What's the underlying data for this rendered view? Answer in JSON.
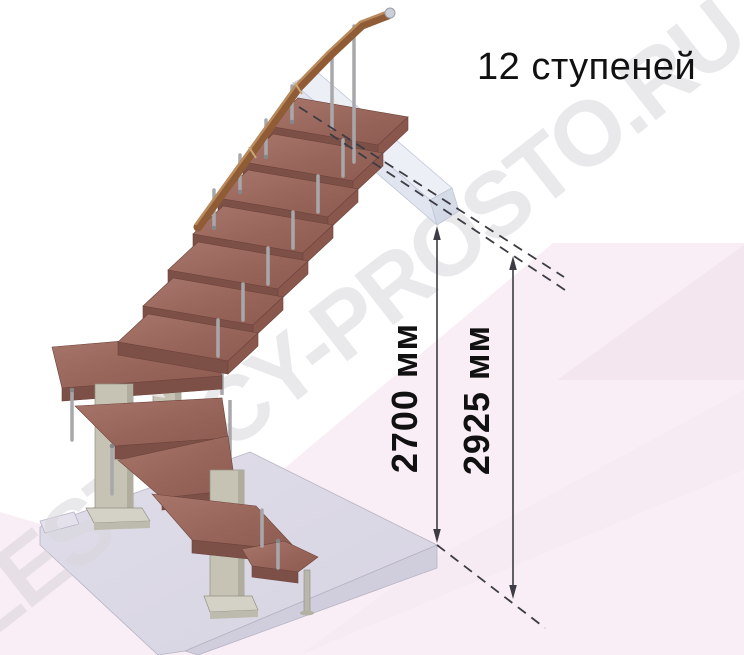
{
  "annotation": {
    "steps_label": "12 ступеней"
  },
  "dimensions": {
    "clear_height": "2700 мм",
    "total_height": "2925 мм"
  },
  "watermark": {
    "text": "LESTNICY-PROSTO.RU"
  },
  "figure": {
    "steps_count": "12"
  },
  "palette": {
    "tread_wood_top": "#9c685e",
    "tread_wood_front": "#7d5047",
    "handrail_wood": "#8f5c36",
    "metal_baluster": "#a8a8ac",
    "steel_column": "#c6c3b5",
    "landing_beam": "#e9ecf4",
    "floor_slab": "#dcd9e7",
    "background_pink": "#f9eef5",
    "background_pink_deep": "#f3e3ee",
    "dimension_line": "#3d3c44",
    "text_color": "#111111"
  }
}
